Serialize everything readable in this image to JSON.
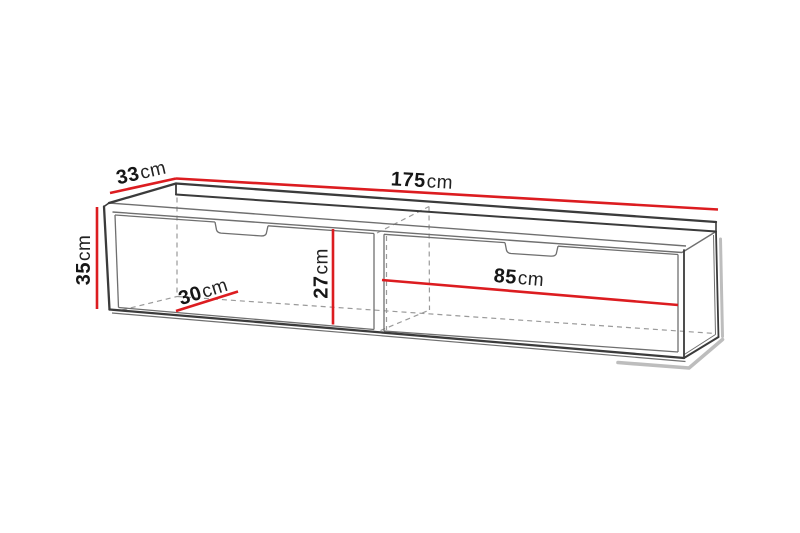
{
  "diagram": {
    "background": "#ffffff",
    "colors": {
      "dimension_line": "#dc1c20",
      "outline_dark": "#3b3b3b",
      "outline_mid": "#6f6f6f",
      "outline_light": "#9c9c9c",
      "hidden_edge": "#9a9a9a",
      "shadow": "#bdbdbd",
      "text": "#161616"
    },
    "dimensions": {
      "width": {
        "value": "175",
        "unit": "cm"
      },
      "depth": {
        "value": "33",
        "unit": "cm"
      },
      "height": {
        "value": "35",
        "unit": "cm"
      },
      "inner_depth": {
        "value": "30",
        "unit": "cm"
      },
      "inner_height": {
        "value": "27",
        "unit": "cm"
      },
      "compartment_width": {
        "value": "85",
        "unit": "cm"
      }
    }
  }
}
